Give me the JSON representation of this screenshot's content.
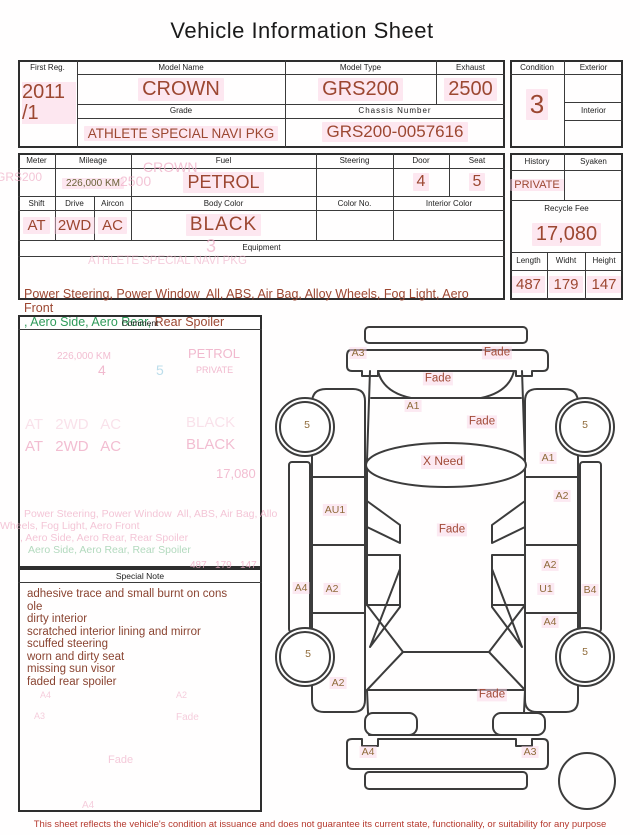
{
  "title": "Vehicle Information Sheet",
  "header": {
    "first_reg": {
      "label": "First Reg.",
      "year": "2011",
      "month": "/1"
    },
    "model_name": {
      "label": "Model Name",
      "value": "CROWN"
    },
    "model_type": {
      "label": "Model Type",
      "value": "GRS200"
    },
    "exhaust": {
      "label": "Exhaust",
      "value": "2500"
    },
    "grade": {
      "label": "Grade",
      "value": "ATHLETE SPECIAL NAVI PKG"
    },
    "chassis_number": {
      "label": "Chassis Number",
      "value": "GRS200-0057616"
    },
    "condition": {
      "label": "Condition",
      "value": "3"
    },
    "exterior": {
      "label": "Exterior",
      "value": ""
    },
    "interior": {
      "label": "Interior",
      "value": ""
    }
  },
  "specs": {
    "meter": {
      "label": "Meter",
      "value": ""
    },
    "mileage": {
      "label": "Mileage",
      "value": "226,000 KM"
    },
    "fuel": {
      "label": "Fuel",
      "value": "PETROL"
    },
    "steering": {
      "label": "Steering",
      "value": ""
    },
    "door": {
      "label": "Door",
      "value": "4"
    },
    "seat": {
      "label": "Seat",
      "value": "5"
    },
    "shift": {
      "label": "Shift",
      "value": "AT"
    },
    "drive": {
      "label": "Drive",
      "value": "2WD"
    },
    "aircon": {
      "label": "Aircon",
      "value": "AC"
    },
    "body_color": {
      "label": "Body Color",
      "value": "BLACK"
    },
    "color_no": {
      "label": "Color No.",
      "value": ""
    },
    "interior_color": {
      "label": "Interior Color",
      "value": ""
    },
    "equipment": {
      "label": "Equipment",
      "line1": "Power Steering, Power Window  All, ABS, Air Bag, Alloy Wheels, Fog Light, Aero Front",
      "line2_green": ", Aero Side, Aero Rear,",
      "line2_red": " Rear Spoiler"
    }
  },
  "right_panel": {
    "history": {
      "label": "History",
      "value": "PRIVATE"
    },
    "syaken": {
      "label": "Syaken",
      "value": ""
    },
    "recycle_fee": {
      "label": "Recycle Fee",
      "value": "17,080"
    },
    "length": {
      "label": "Length",
      "value": "487"
    },
    "width": {
      "label": "Widht",
      "value": "179"
    },
    "height": {
      "label": "Height",
      "value": "147"
    }
  },
  "comment": {
    "label": "Comment"
  },
  "special_note": {
    "label": "Special Note",
    "lines": [
      "adhesive trace and small burnt on cons",
      "ole",
      "dirty interior",
      "scratched interior lining and mirror",
      "scuffed steering",
      "worn and dirty seat",
      "missing sun visor",
      "faded rear spoiler"
    ]
  },
  "diagram": {
    "labels": {
      "rear_bumper_left": "A3",
      "rear_bumper_right": "Fade",
      "rear_glass": "Fade",
      "trunk_left": "A1",
      "trunk_right": "Fade",
      "roof": "X Need",
      "right_quarter": "A1",
      "wheel_rear_left": "5",
      "wheel_rear_right": "5",
      "left_rear_door": "AU1",
      "right_rear_door": "A2",
      "cabin": "Fade",
      "right_door_a2": "A2",
      "left_sill": "A4",
      "left_front_door": "A2",
      "right_door_u1": "U1",
      "right_sill": "B4",
      "right_fender": "A4",
      "wheel_front_left": "5",
      "wheel_front_right": "5",
      "left_fender": "A2",
      "hood": "Fade",
      "front_bumper_left": "A4",
      "front_bumper_right": "A3"
    }
  },
  "ghost_text": {
    "margin": "GRS200",
    "model": "CROWN",
    "exhaust": "2500",
    "condition": "3",
    "grade": "ATHLETE SPECIAL NAVI PKG",
    "mileage": "226,000 KM",
    "fuel": "PETROL",
    "door": "4",
    "seat": "5",
    "history": "PRIVATE",
    "shift_row": "AT   2WD   AC",
    "body_color": "BLACK",
    "fee": "17,080",
    "equip1": "Power Steering, Power Window  All, ABS, Air Bag, Allo",
    "equip2": "Wheels, Fog Light, Aero Front",
    "equip3": ", Aero Side, Aero Rear, Rear Spoiler",
    "equip4": "Aero Side, Aero Rear, Rear Spoiler",
    "dims": "487   179   147",
    "note_a4": "A4",
    "note_a2": "A2",
    "note_a3": "A3",
    "note_fade1": "Fade",
    "note_fade2": "Fade",
    "footer_a4": "A4"
  },
  "footer": {
    "disclaimer": "This sheet reflects the vehicle's condition at issuance and does not guarantee its current state, functionality, or suitability for any purpose"
  },
  "colors": {
    "value_red": "#9c4731",
    "note_red": "#8a4431",
    "diagram_label_brown": "#8f6b3a",
    "fade_red": "#a14a36",
    "ghost_pink": "#efadc6",
    "highlight_pink": "#facde0",
    "mileage_olive": "#6b6138",
    "equipment_green": "#2f9a5a",
    "disclaimer_red": "#b5392e"
  }
}
